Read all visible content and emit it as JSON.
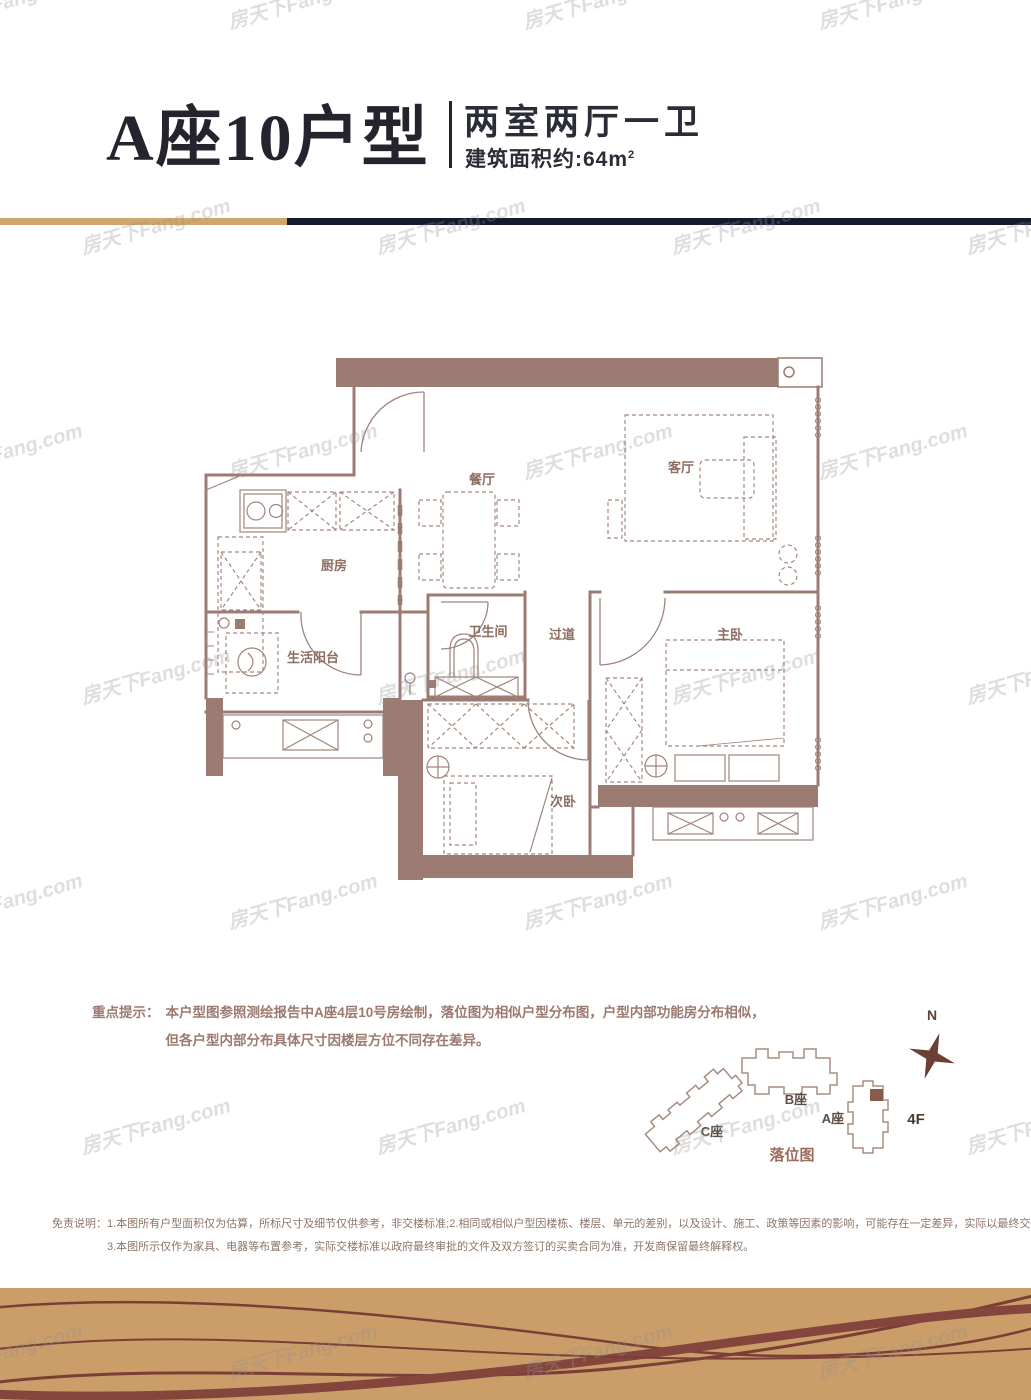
{
  "page": {
    "title": "A座10户型",
    "subtitle": "两室两厅一卫",
    "area_prefix": "建筑面积约:64m",
    "area_sup": "2"
  },
  "watermark": {
    "text": "房天下Fang.com"
  },
  "floorplan": {
    "rooms": [
      {
        "id": "dining",
        "label": "餐厅"
      },
      {
        "id": "living",
        "label": "客厅"
      },
      {
        "id": "kitchen",
        "label": "厨房"
      },
      {
        "id": "balcony",
        "label": "生活阳台"
      },
      {
        "id": "bathroom",
        "label": "卫生间"
      },
      {
        "id": "corridor",
        "label": "过道"
      },
      {
        "id": "master",
        "label": "主卧"
      },
      {
        "id": "second",
        "label": "次卧"
      }
    ],
    "wall_color": "#9c7b73",
    "line_color": "#a1837b"
  },
  "notice": {
    "label": "重点提示：",
    "line1": "本户型图参照测绘报告中A座4层10号房绘制，落位图为相似户型分布图，户型内部功能房分布相似，",
    "line2": "但各户型内部分布具体尺寸因楼层方位不同存在差异。"
  },
  "locator": {
    "north_label": "N",
    "buildings": [
      {
        "label": "B座"
      },
      {
        "label": "C座"
      },
      {
        "label": "A座"
      }
    ],
    "floor_label": "4F",
    "caption": "落位图",
    "highlight_color": "#8a5a4d"
  },
  "disclaimer": {
    "label": "免责说明：",
    "line1": "1.本图所有户型面积仅为估算，所标尺寸及细节仅供参考，非交楼标准;2.相同或相似户型因楼栋、楼层、单元的差别，以及设计、施工、政策等因素的影响，可能存在一定差异，实际以最终交楼情况为准；",
    "line2": "3.本图所示仅作为家具、电器等布置参考，实际交楼标准以政府最终审批的文件及双方签订的买卖合同为准，开发商保留最终解释权。"
  },
  "colors": {
    "accent_gold": "#d1a66b",
    "accent_navy": "#141b2c",
    "band_bg": "#cb9d69",
    "band_wave": "#7a3e36",
    "title_text": "#23242e",
    "notice_text": "#9b7a6f",
    "disclaimer_text": "#8d7568"
  }
}
